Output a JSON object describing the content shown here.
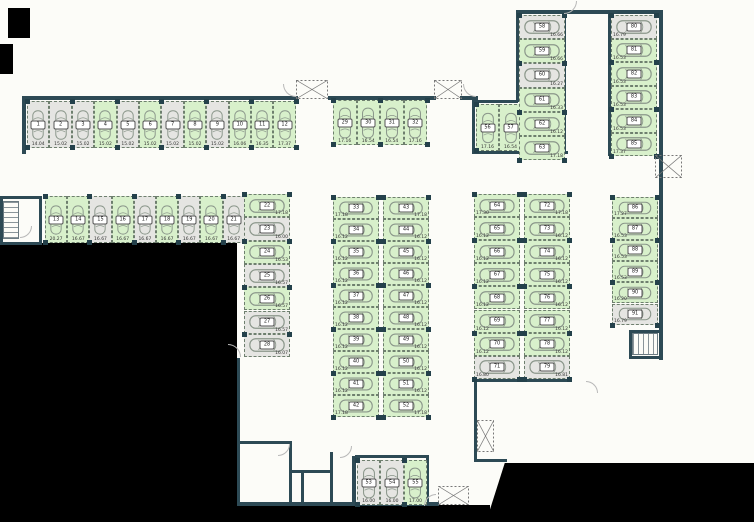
{
  "plan": {
    "canvas": {
      "width": 754,
      "height": 522
    },
    "colors": {
      "available": "#d8f0cb",
      "occupied": "#e5e5e2",
      "wall": "#2d4a55",
      "stall_border": "#6e7f6e",
      "car_outline": "#8a968a",
      "blocked": "#000000"
    },
    "statuses": {
      "available": "green stall",
      "occupied": "gray stall"
    },
    "groups": [
      {
        "name": "top-row",
        "orient": "v",
        "x": 27,
        "y": 101,
        "dx": 22.4,
        "dy": 0,
        "w": 22.4,
        "h": 47,
        "label": "bottom",
        "stalls": [
          [
            "1",
            "14.04",
            "occupied"
          ],
          [
            "2",
            "15.02",
            "occupied"
          ],
          [
            "3",
            "15.02",
            "occupied"
          ],
          [
            "4",
            "15.02",
            "available"
          ],
          [
            "5",
            "15.02",
            "occupied"
          ],
          [
            "6",
            "15.02",
            "available"
          ],
          [
            "7",
            "15.02",
            "occupied"
          ],
          [
            "8",
            "15.02",
            "available"
          ],
          [
            "9",
            "15.02",
            "occupied"
          ],
          [
            "10",
            "16.06",
            "available"
          ],
          [
            "11",
            "16.35",
            "available"
          ],
          [
            "12",
            "17.37",
            "available"
          ]
        ]
      },
      {
        "name": "second-row",
        "orient": "v",
        "x": 45,
        "y": 196,
        "dx": 22.2,
        "dy": 0,
        "w": 22.2,
        "h": 47,
        "label": "bottom",
        "stalls": [
          [
            "13",
            "20.27",
            "available"
          ],
          [
            "14",
            "16.67",
            "available"
          ],
          [
            "15",
            "16.67",
            "occupied"
          ],
          [
            "16",
            "16.67",
            "available"
          ],
          [
            "17",
            "16.67",
            "occupied"
          ],
          [
            "18",
            "16.67",
            "available"
          ],
          [
            "19",
            "16.67",
            "occupied"
          ],
          [
            "20",
            "16.67",
            "available"
          ],
          [
            "21",
            "16.67",
            "occupied"
          ]
        ]
      },
      {
        "name": "west-column",
        "orient": "h",
        "x": 244,
        "y": 194,
        "dx": 0,
        "dy": 23.3,
        "w": 46,
        "h": 23.3,
        "label": "right",
        "stalls": [
          [
            "22",
            "17.18",
            "available"
          ],
          [
            "23",
            "16.00",
            "occupied"
          ],
          [
            "24",
            "16.53",
            "available"
          ],
          [
            "25",
            "16.57",
            "occupied"
          ],
          [
            "26",
            "16.57",
            "available"
          ],
          [
            "27",
            "16.57",
            "occupied"
          ],
          [
            "28",
            "16.07",
            "occupied"
          ]
        ]
      },
      {
        "name": "center-top-row",
        "orient": "v",
        "x": 333,
        "y": 100,
        "dx": 23.5,
        "dy": 0,
        "w": 23.5,
        "h": 45,
        "label": "bottom",
        "stalls": [
          [
            "29",
            "17.16",
            "available"
          ],
          [
            "30",
            "16.54",
            "available"
          ],
          [
            "31",
            "16.54",
            "available"
          ],
          [
            "32",
            "17.16",
            "available"
          ]
        ]
      },
      {
        "name": "center-col-a",
        "orient": "h",
        "x": 333,
        "y": 197,
        "dx": 0,
        "dy": 22,
        "w": 46,
        "h": 22,
        "label": "left",
        "stalls": [
          [
            "33",
            "17.18",
            "available"
          ],
          [
            "34",
            "16.12",
            "available"
          ],
          [
            "35",
            "16.12",
            "available"
          ],
          [
            "36",
            "16.12",
            "available"
          ],
          [
            "37",
            "16.12",
            "available"
          ],
          [
            "38",
            "16.12",
            "available"
          ],
          [
            "39",
            "16.12",
            "available"
          ],
          [
            "40",
            "16.12",
            "available"
          ],
          [
            "41",
            "16.12",
            "available"
          ],
          [
            "42",
            "17.18",
            "available"
          ]
        ]
      },
      {
        "name": "center-col-b",
        "orient": "h",
        "x": 383,
        "y": 197,
        "dx": 0,
        "dy": 22,
        "w": 46,
        "h": 22,
        "label": "right",
        "stalls": [
          [
            "43",
            "17.18",
            "available"
          ],
          [
            "44",
            "16.12",
            "available"
          ],
          [
            "45",
            "16.12",
            "available"
          ],
          [
            "46",
            "16.12",
            "available"
          ],
          [
            "47",
            "16.12",
            "available"
          ],
          [
            "48",
            "16.12",
            "available"
          ],
          [
            "49",
            "16.12",
            "available"
          ],
          [
            "50",
            "16.12",
            "available"
          ],
          [
            "51",
            "16.12",
            "available"
          ],
          [
            "52",
            "17.18",
            "available"
          ]
        ]
      },
      {
        "name": "bottom-row",
        "orient": "v",
        "x": 357,
        "y": 460,
        "dx": 23.4,
        "dy": 0,
        "w": 23.4,
        "h": 45,
        "label": "bottom",
        "stalls": [
          [
            "53",
            "16.00",
            "occupied"
          ],
          [
            "54",
            "16.00",
            "occupied"
          ],
          [
            "55",
            "17.00",
            "available"
          ]
        ]
      },
      {
        "name": "upper-right-pair",
        "orient": "v",
        "x": 476,
        "y": 104,
        "dx": 23,
        "dy": 0,
        "w": 23,
        "h": 47,
        "label": "bottom",
        "stalls": [
          [
            "56",
            "17.16",
            "available"
          ],
          [
            "57",
            "16.54",
            "available"
          ]
        ]
      },
      {
        "name": "upper-right-col",
        "orient": "h",
        "x": 519,
        "y": 15,
        "dx": 0,
        "dy": 24.2,
        "w": 46,
        "h": 24.2,
        "label": "right",
        "stalls": [
          [
            "58",
            "16.66",
            "occupied"
          ],
          [
            "59",
            "16.66",
            "available"
          ],
          [
            "60",
            "16.27",
            "occupied"
          ],
          [
            "61",
            "16.33",
            "available"
          ],
          [
            "62",
            "16.12",
            "available"
          ],
          [
            "63",
            "17.18",
            "available"
          ]
        ]
      },
      {
        "name": "far-right-top-col",
        "orient": "h",
        "x": 611,
        "y": 15,
        "dx": 0,
        "dy": 23.5,
        "w": 46,
        "h": 23.5,
        "label": "left",
        "stalls": [
          [
            "80",
            "16.79",
            "occupied"
          ],
          [
            "81",
            "16.53",
            "available"
          ],
          [
            "82",
            "16.53",
            "available"
          ],
          [
            "83",
            "16.53",
            "available"
          ],
          [
            "84",
            "16.53",
            "available"
          ],
          [
            "85",
            "17.37",
            "available"
          ]
        ]
      },
      {
        "name": "right-block-col-a",
        "orient": "h",
        "x": 474,
        "y": 194,
        "dx": 0,
        "dy": 23.1,
        "w": 46,
        "h": 23.1,
        "label": "left",
        "stalls": [
          [
            "64",
            "17.30",
            "available"
          ],
          [
            "65",
            "16.12",
            "available"
          ],
          [
            "66",
            "16.12",
            "available"
          ],
          [
            "67",
            "16.12",
            "available"
          ],
          [
            "68",
            "16.12",
            "available"
          ],
          [
            "69",
            "16.12",
            "available"
          ],
          [
            "70",
            "16.12",
            "available"
          ],
          [
            "71",
            "16.80",
            "occupied"
          ]
        ]
      },
      {
        "name": "right-block-col-b",
        "orient": "h",
        "x": 524,
        "y": 194,
        "dx": 0,
        "dy": 23.1,
        "w": 46,
        "h": 23.1,
        "label": "right",
        "stalls": [
          [
            "72",
            "17.18",
            "available"
          ],
          [
            "73",
            "16.12",
            "available"
          ],
          [
            "74",
            "16.12",
            "available"
          ],
          [
            "75",
            "16.12",
            "available"
          ],
          [
            "76",
            "16.12",
            "available"
          ],
          [
            "77",
            "16.12",
            "available"
          ],
          [
            "78",
            "16.12",
            "available"
          ],
          [
            "79",
            "16.81",
            "occupied"
          ]
        ]
      },
      {
        "name": "far-right-bottom-col",
        "orient": "h",
        "x": 612,
        "y": 197,
        "dx": 0,
        "dy": 21.3,
        "w": 46,
        "h": 21.3,
        "label": "left",
        "stalls": [
          [
            "86",
            "17.27",
            "available"
          ],
          [
            "87",
            "16.53",
            "available"
          ],
          [
            "88",
            "16.53",
            "available"
          ],
          [
            "89",
            "16.53",
            "available"
          ],
          [
            "90",
            "16.20",
            "available"
          ],
          [
            "91",
            "16.79",
            "occupied"
          ]
        ]
      }
    ]
  }
}
